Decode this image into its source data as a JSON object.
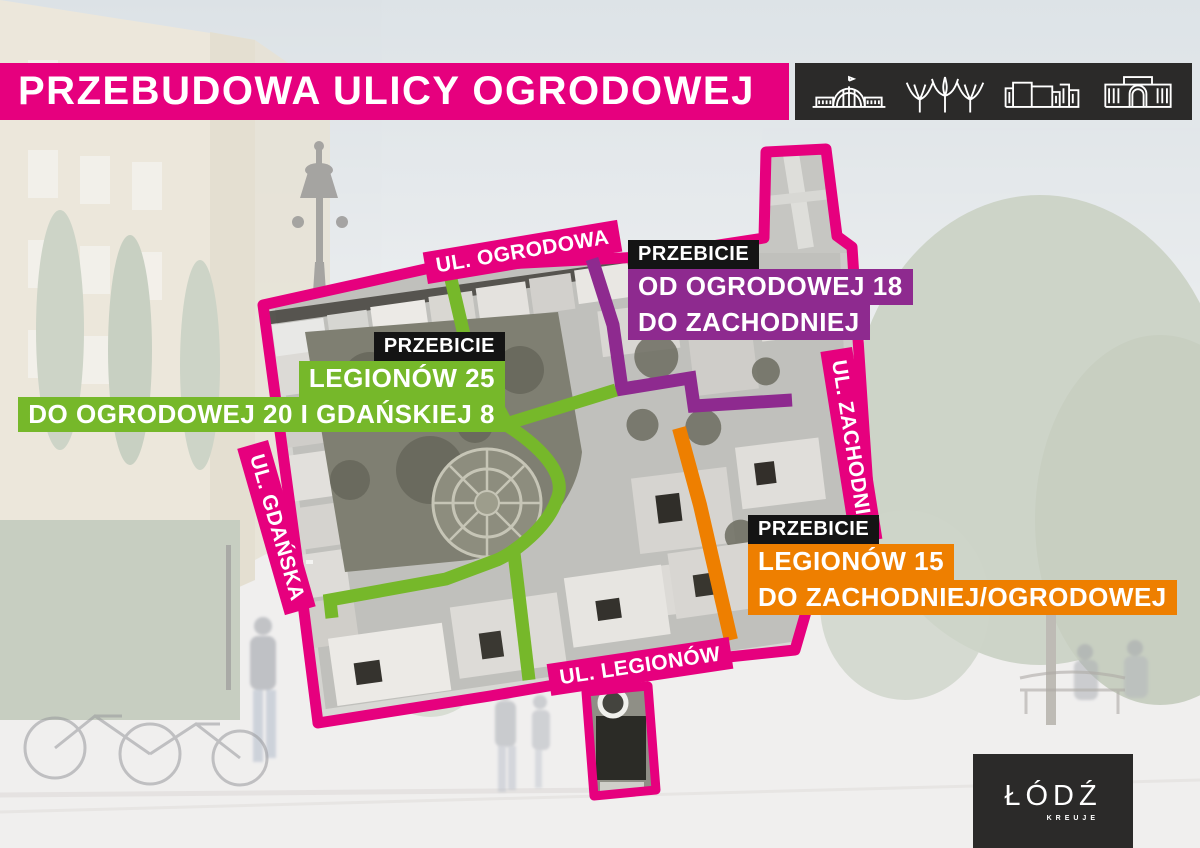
{
  "colors": {
    "pink": "#E6007E",
    "green": "#76B82A",
    "purple": "#8E2A8F",
    "orange": "#EE7F00",
    "dark": "#2B2A29",
    "tag": "#141414"
  },
  "title_bar": {
    "title": "PRZEBUDOWA ULICY OGRODOWEJ"
  },
  "landmark_bar": {
    "icons": [
      {
        "name": "market-hall-icon"
      },
      {
        "name": "canopy-trees-icon"
      },
      {
        "name": "modern-complex-icon"
      },
      {
        "name": "arch-portal-building-icon"
      }
    ]
  },
  "map": {
    "street_labels": [
      {
        "text": "UL. OGRODOWA"
      },
      {
        "text": "UL. GDAŃSKA"
      },
      {
        "text": "UL. ZACHODNIA"
      },
      {
        "text": "UL. LEGIONÓW"
      }
    ],
    "callouts": [
      {
        "tag": "PRZEBICIE",
        "line1": "LEGIONÓW 25",
        "line2": "DO OGRODOWEJ 20 I GDAŃSKIEJ 8",
        "color": "#76B82A"
      },
      {
        "tag": "PRZEBICIE",
        "line1": "OD OGRODOWEJ 18",
        "line2": "DO ZACHODNIEJ",
        "color": "#8E2A8F"
      },
      {
        "tag": "PRZEBICIE",
        "line1": "LEGIONÓW 15",
        "line2": "DO ZACHODNIEJ/OGRODOWEJ",
        "color": "#EE7F00"
      }
    ]
  },
  "logo": {
    "city": "ŁÓDŹ",
    "tagline": "KREUJE"
  }
}
